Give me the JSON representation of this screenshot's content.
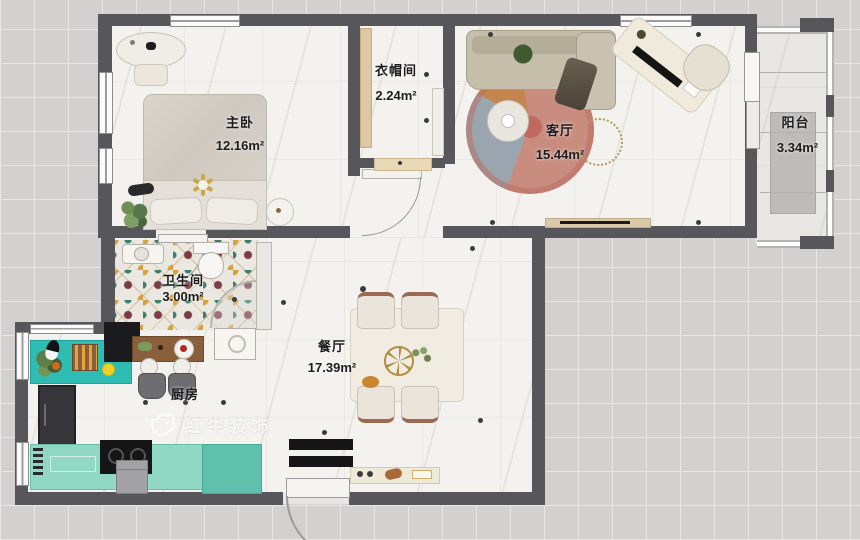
{
  "plan": {
    "watermark": {
      "brand": "红牛装饰"
    },
    "rooms": [
      {
        "key": "master_bedroom",
        "name": "主卧",
        "area": "12.16m²"
      },
      {
        "key": "cloakroom",
        "name": "衣帽间",
        "area": "2.24m²"
      },
      {
        "key": "living_room",
        "name": "客厅",
        "area": "15.44m²"
      },
      {
        "key": "balcony",
        "name": "阳台",
        "area": "3.34m²"
      },
      {
        "key": "bathroom",
        "name": "卫生间",
        "area": "3.00m²"
      },
      {
        "key": "dining_room",
        "name": "餐厅",
        "area": "17.39m²"
      },
      {
        "key": "kitchen",
        "name": "厨房",
        "area": ""
      }
    ],
    "colors": {
      "wall": "#57565b",
      "floor_marble": "#f4f2ef",
      "kitchen_counter_teal": "#2fbdb3",
      "kitchen_counter_mint": "#90d7c4",
      "rug_salmon": "#c98d80",
      "rug_bluegray": "#9aa5b0",
      "rug_orange": "#c4854e",
      "tile_teal": "#3e7d6d",
      "tile_maroon": "#7a3b44",
      "tile_gold": "#d9a13a"
    }
  }
}
